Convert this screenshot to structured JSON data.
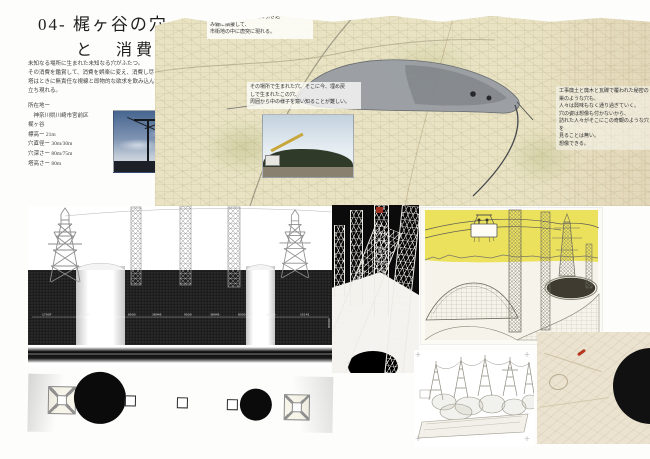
{
  "header": {
    "title_line1": "04- 梶ヶ谷の穴",
    "title_line2": "と　消費の塔",
    "intro_lines": [
      "未知なる場所に生まれた未知なる穴がふたつ。",
      "その消費を鑑賞して、消費を娯楽に変え、消費し尽くす。",
      "塔はときに無責任な視線と即物的な欲求を飲み込んで",
      "立ち現れる。"
    ],
    "site_info": [
      "所在地ー",
      "　神奈川県川崎市宮前区",
      "梶ヶ谷",
      "標高ー 21m",
      "穴直径ー 30m/30m",
      "穴深さー 80m/75m",
      "塔高さー 80m"
    ]
  },
  "map": {
    "note_topleft_lines": [
      "梶ヶ谷の穴は、貨物駅の引き込",
      "み線に隣接して、",
      "市街地の中に唐突に現れる。"
    ],
    "photo_caption_lines": [
      "その場所で生まれた穴、そこに今、埋め戻",
      "しで生まれたこの穴、",
      "周囲から中の様子を窺い知ることが難しい。"
    ],
    "note_right_lines": [
      "工事廃土と廃木と瓦礫で覆われた秘密の",
      "巣のような穴も、",
      "人々は興味もなく通り過ぎていく。",
      "",
      "穴の姿は想像も付かないから、",
      "訪れた人々がそこにこの奇観のような穴を",
      "見ることは無い。",
      "想像できる。"
    ]
  },
  "section": {
    "dims": [
      "17007",
      "30000",
      "8000",
      "38945",
      "9500",
      "38945",
      "8000",
      "30000",
      "15141"
    ],
    "side_dim": "80000"
  },
  "palette": {
    "map_paper": "#e9e3c4",
    "illustration_sky": "#ebe15c",
    "paper_beige": "#ebe3cf",
    "marker_red": "#b5371f",
    "ground_black": "#1f1f1f"
  }
}
